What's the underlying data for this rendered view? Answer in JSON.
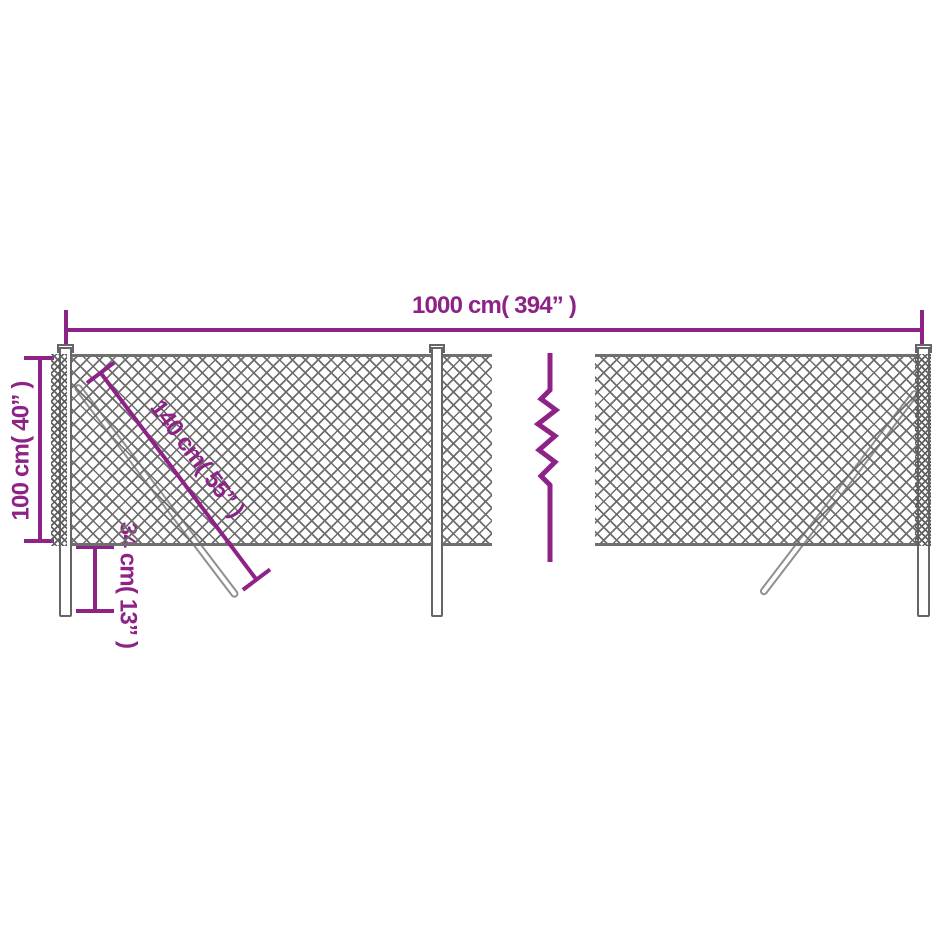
{
  "colors": {
    "dimension_magenta": "#8D2287",
    "mesh_gray": "#6E6E6E",
    "post_gray": "#656565"
  },
  "dimensions": {
    "total_width": "1000 cm( 394” )",
    "fence_height": "100 cm( 40” )",
    "brace_length": "140 cm( 55” )",
    "ground_depth": "34 cm( 13” )"
  }
}
